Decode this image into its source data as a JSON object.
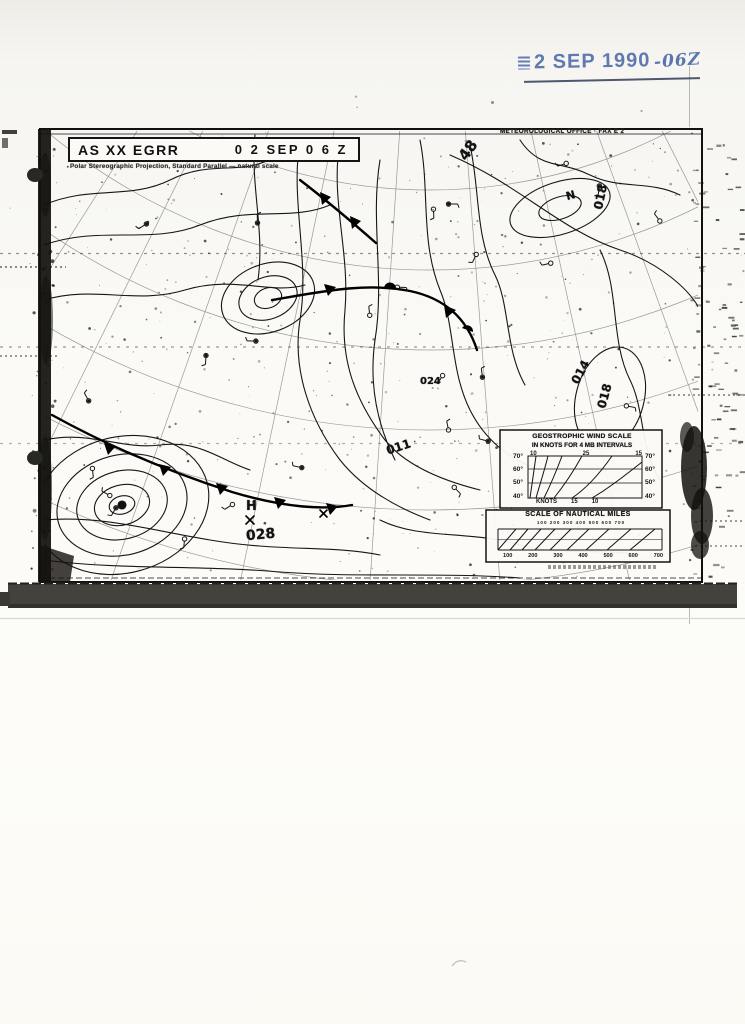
{
  "stamp": {
    "date": "2 SEP 1990",
    "zulu_suffix": "-06Z",
    "ink_color": "#4060a4"
  },
  "chart_header": {
    "id_left": "AS XX EGRR",
    "datetime_right": "0 2 SEP 0 6 Z",
    "subtitle": "Polar Stereographic Projection, Standard Parallel — natural scale",
    "office_line": "METEOROLOGICAL OFFICE · FAX E 2"
  },
  "wind_scale": {
    "title_line1": "GEOSTROPHIC WIND SCALE",
    "title_line2": "IN KNOTS FOR 4 MB INTERVALS",
    "top_ticks": [
      "10",
      "25",
      "15"
    ],
    "left_latitudes": [
      "70°",
      "60°",
      "50°",
      "40°"
    ],
    "right_latitudes": [
      "70°",
      "60°",
      "50°",
      "40°"
    ],
    "bottom_label": "KNOTS",
    "bottom_ticks": [
      "15",
      "10"
    ]
  },
  "nautical_scale": {
    "title": "SCALE OF NAUTICAL MILES",
    "upper_ticks": "100 200 300 400 500 600 700",
    "lower_ticks": [
      "100",
      "200",
      "300",
      "400",
      "500",
      "600",
      "700"
    ]
  },
  "map_labels": [
    {
      "text": "48"
    },
    {
      "text": "N"
    },
    {
      "text": "018"
    },
    {
      "text": "014"
    },
    {
      "text": "018"
    },
    {
      "text": "011"
    },
    {
      "text": "024"
    },
    {
      "text": "H"
    },
    {
      "text": "028"
    }
  ],
  "ink": {
    "map": "#161616",
    "paper": "#faf9f5"
  }
}
